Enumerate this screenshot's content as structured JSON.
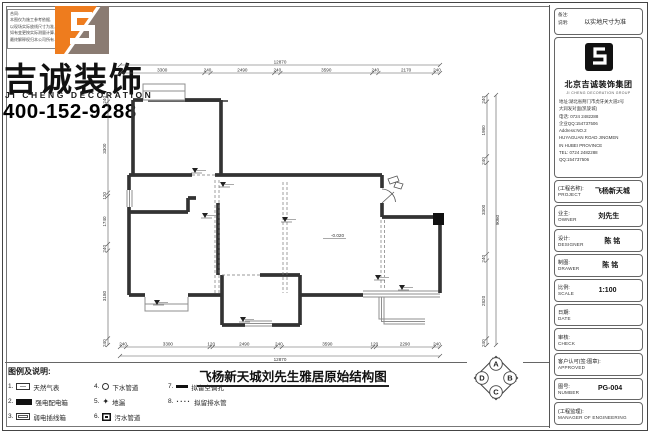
{
  "brand": {
    "name_cn": "吉诚装饰",
    "name_en": "JI CHENG DECORATION",
    "phone": "400-152-9288",
    "note_title": "合同:",
    "note_lines": [
      "本图仅为施工参考依据,",
      "以现场实际放线尺寸为准,",
      "如有变更按实际测量计算,",
      "最终解释权归本公司所有."
    ]
  },
  "drawing": {
    "title": "飞杨新天城刘先生雅居原始结构图",
    "floor_level_label": "-0.020"
  },
  "plan": {
    "dim_top_overall": "12870",
    "dim_top_segments": [
      "3300",
      "240",
      "2490",
      "240",
      "3590",
      "240",
      "2170",
      "240"
    ],
    "dim_bottom_overall": "12870",
    "dim_bottom_segments": [
      "240",
      "3300",
      "120",
      "2490",
      "240",
      "3590",
      "120",
      "2290",
      "240"
    ],
    "dim_left_segments": [
      "240",
      "3300",
      "120",
      "1740",
      "240",
      "3180",
      "240"
    ],
    "dim_right_overall": "9060",
    "dim_right_segments": [
      "240",
      "1980",
      "240",
      "3300",
      "240",
      "2820",
      "240"
    ],
    "level_point": {
      "x": 228,
      "y": 182
    },
    "markers": [
      {
        "x": 95,
        "y": 118
      },
      {
        "x": 123,
        "y": 132
      },
      {
        "x": 105,
        "y": 163
      },
      {
        "x": 185,
        "y": 167
      },
      {
        "x": 278,
        "y": 225
      },
      {
        "x": 302,
        "y": 235
      },
      {
        "x": 57,
        "y": 250
      },
      {
        "x": 143,
        "y": 267
      }
    ]
  },
  "legend": {
    "title": "图例及说明:",
    "items": [
      {
        "num": "1.",
        "symbol": "gas-meter",
        "label": "天然气表"
      },
      {
        "num": "2.",
        "symbol": "strong-box",
        "label": "强电配电箱"
      },
      {
        "num": "3.",
        "symbol": "weak-box",
        "label": "弱电插线箱"
      },
      {
        "num": "4.",
        "symbol": "drain-circle",
        "label": "下水管道"
      },
      {
        "num": "5.",
        "symbol": "floor-drain",
        "label": "地漏"
      },
      {
        "num": "6.",
        "symbol": "sewage-box",
        "label": "污水管道"
      },
      {
        "num": "7.",
        "symbol": "ac-hole",
        "label": "拟留空调孔"
      },
      {
        "num": "8.",
        "symbol": "dotted-pipe",
        "label": "拟留排水管"
      }
    ]
  },
  "compass": {
    "labels": [
      "A",
      "B",
      "C",
      "D"
    ]
  },
  "titleblock": {
    "notes": {
      "label1": "备注:",
      "label2": "说明:",
      "value": "以实地尺寸为准"
    },
    "company": {
      "name": "北京吉诚装饰集团",
      "name_en": "JI CHENG DECORATION GROUP",
      "addr1": "地址:湖北省荆门市虎牙关大道2号",
      "addr2": "大润发对面(凯旋城)",
      "tel_cn": "电话: 0724 2482288",
      "qq_cn": "企业QQ:154737506",
      "addr_en1": "Address:NO.2",
      "addr_en2": "HUYAGUAN ROAD JINGMEN",
      "addr_en3": "IN HUBEI PROVINCE",
      "tel_en": "TEL: 0724 2482288",
      "qq_en": "QQ:154737506"
    },
    "fields": [
      {
        "cn": "(工程名称):",
        "en": "PROJECT",
        "value": "飞杨新天城"
      },
      {
        "cn": "业主:",
        "en": "OWNER",
        "value": "刘先生"
      },
      {
        "cn": "设计:",
        "en": "DESIGNER",
        "value": "陈 铭"
      },
      {
        "cn": "制图:",
        "en": "DRAWER",
        "value": "陈 铭"
      },
      {
        "cn": "比例:",
        "en": "SCALE",
        "value": "1:100"
      },
      {
        "cn": "日期:",
        "en": "DATE",
        "value": ""
      },
      {
        "cn": "审核:",
        "en": "CHECK",
        "value": ""
      },
      {
        "cn": "客户认可(签:图章):",
        "en": "APPROVED",
        "value": ""
      },
      {
        "cn": "图号:",
        "en": "NUMBER",
        "value": "PG-004"
      },
      {
        "cn": "(工程监理):",
        "en": "MANAGER OF ENGINEERING",
        "value": ""
      }
    ]
  },
  "colors": {
    "accent_orange": "#EE7C1E",
    "logo_gray": "#8A7B72",
    "wall_line": "#333333",
    "window_line": "#8f8f8f"
  }
}
